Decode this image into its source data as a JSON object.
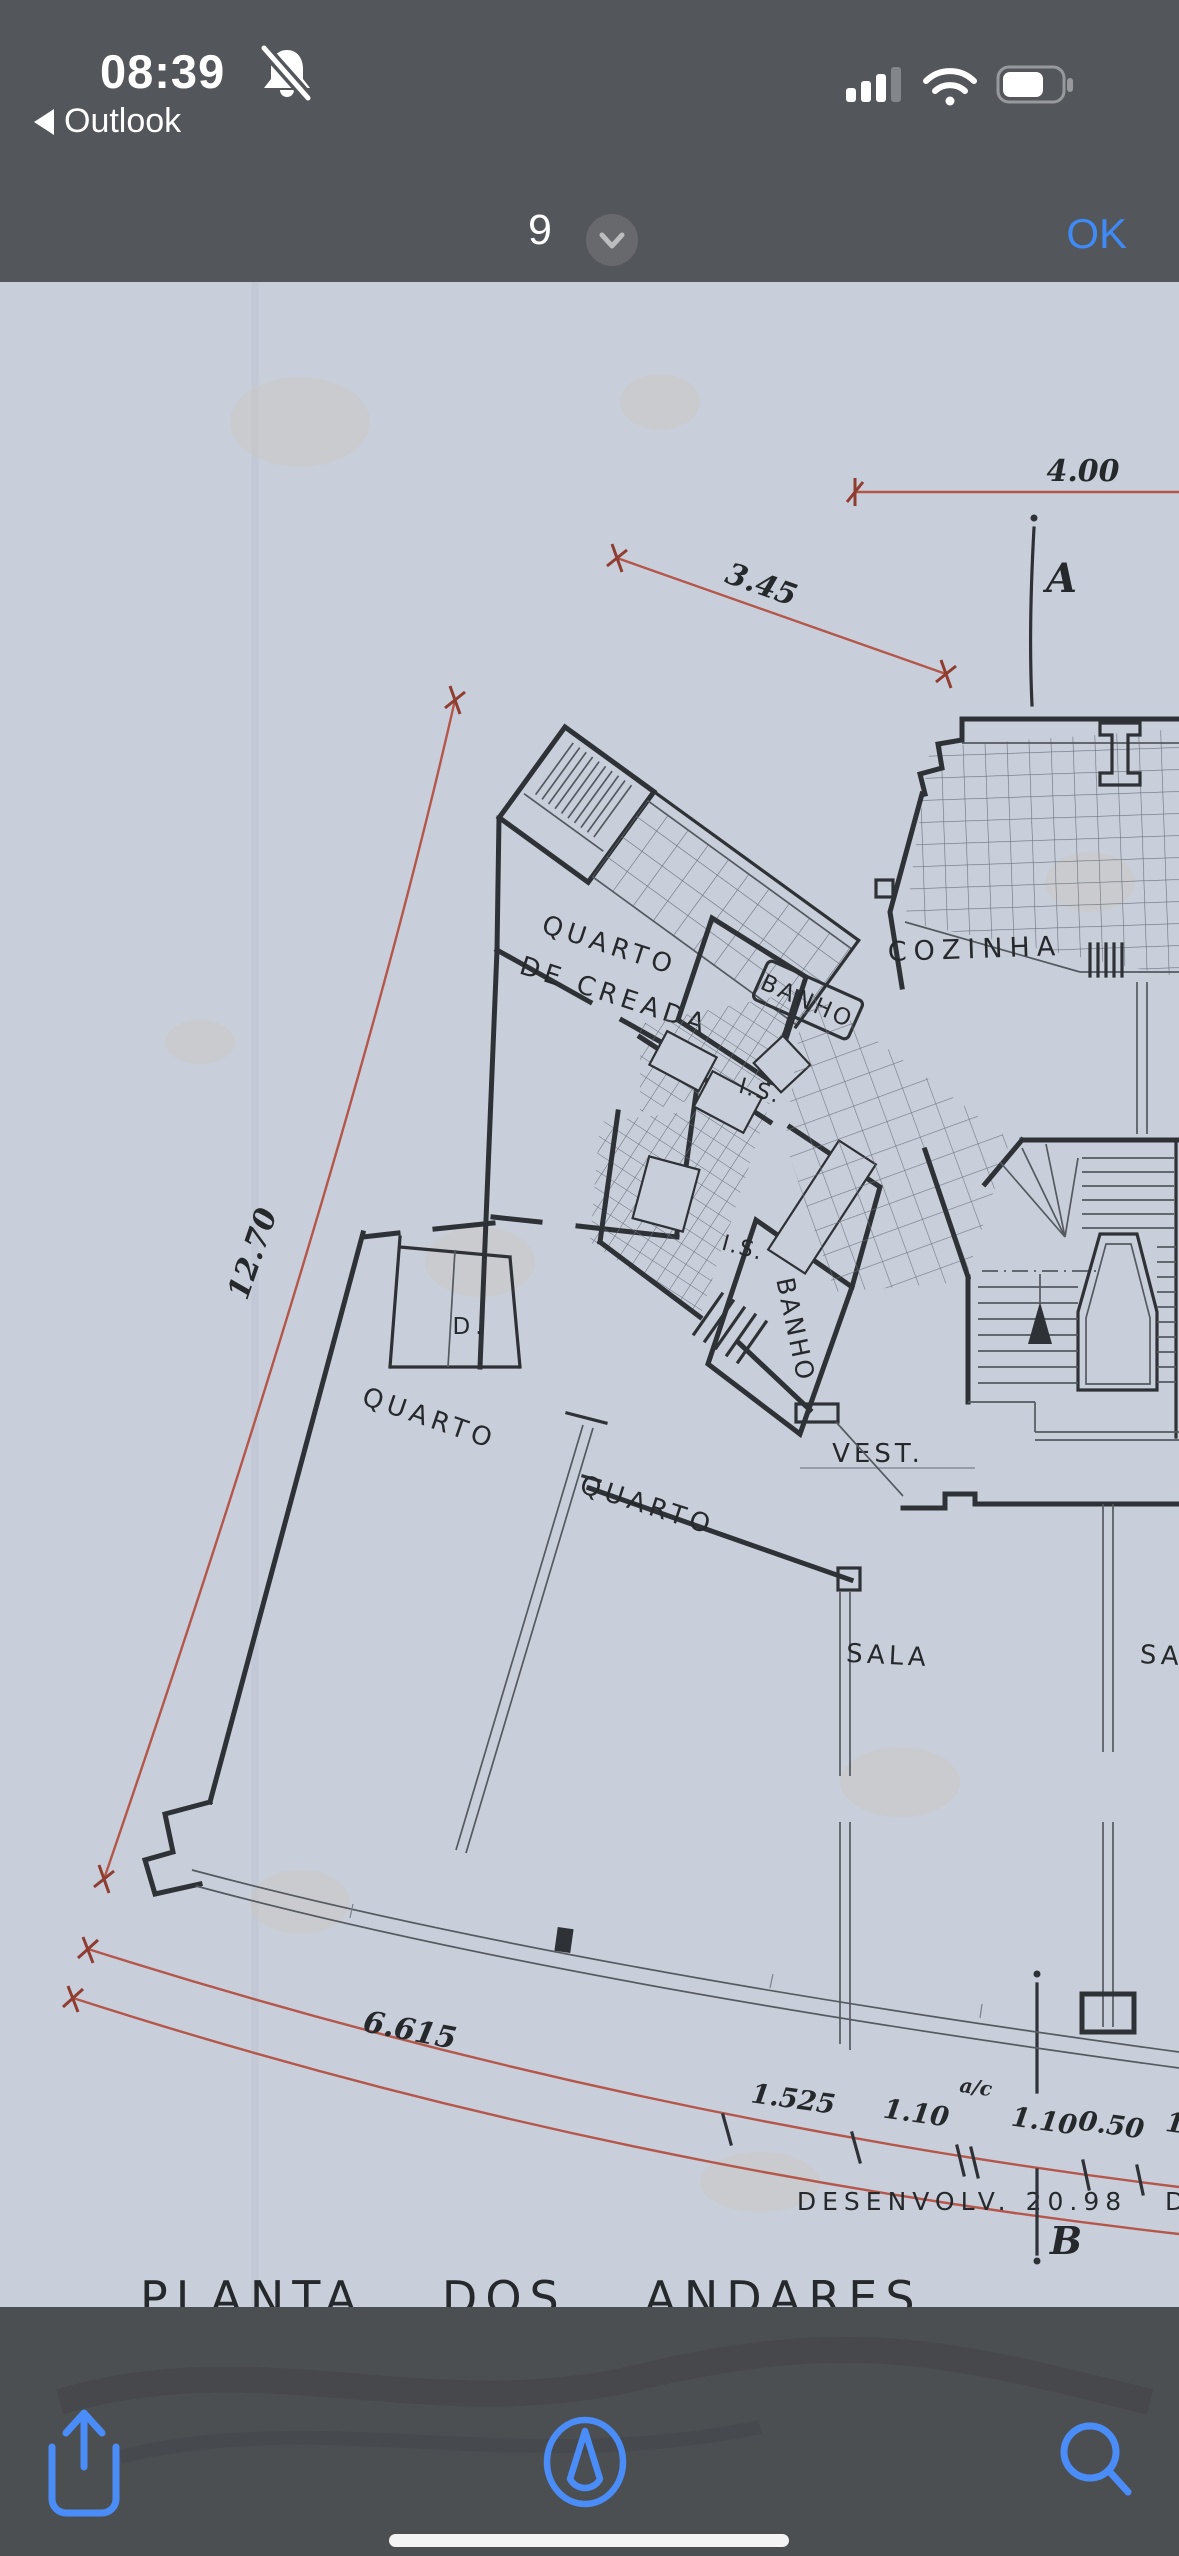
{
  "status_bar": {
    "time": "08:39",
    "bell_icon": "notifications-silenced",
    "back_symbol": "◀",
    "back_app": "Outlook",
    "signal_bars_filled": 3,
    "signal_bars_total": 4,
    "wifi": "full",
    "battery_percent_visual": 60
  },
  "nav_bar": {
    "page_number": "9",
    "chevron": "down",
    "confirm_label": "OK"
  },
  "toolbar": {
    "icons": [
      "share-icon",
      "markup-compass-icon",
      "search-icon"
    ]
  },
  "plan": {
    "title": "PLANTA DOS ANDARES",
    "room_labels": {
      "cozinha": "COZINHA",
      "quarto_creada_line1": "QUARTO",
      "quarto_creada_line2": "DE CREADA",
      "banho_1": "BANHO",
      "is_1": "I.S.",
      "is_2": "I.S.",
      "banho_2": "BANHO",
      "vest": "VEST.",
      "quarto_1": "QUARTO",
      "quarto_2": "QUARTO",
      "closet": "D.",
      "sala_1": "SALA",
      "sala_2": "SA"
    },
    "dimensions": {
      "top": "4.00",
      "diagonal": "3.45",
      "left_side": "12.70",
      "bottom_left": "6.615",
      "seg_1": "1.525",
      "seg_2": "1.10",
      "seg_2_note": "a/c",
      "seg_3": "1.10",
      "seg_4": "0.50",
      "seg_5_partial": "1",
      "developed": "DESENVOLV. 20.98",
      "developed_partial": "D"
    },
    "section_markers": {
      "a": "A",
      "b": "B"
    },
    "colors": {
      "paper": "#c9cedb",
      "ink": "#2e3236",
      "dimension_red": "#b4574a",
      "header_gray": "#53565a",
      "accent_blue": "#3e8bf7",
      "toolbar_blue": "#4a8df8"
    }
  }
}
